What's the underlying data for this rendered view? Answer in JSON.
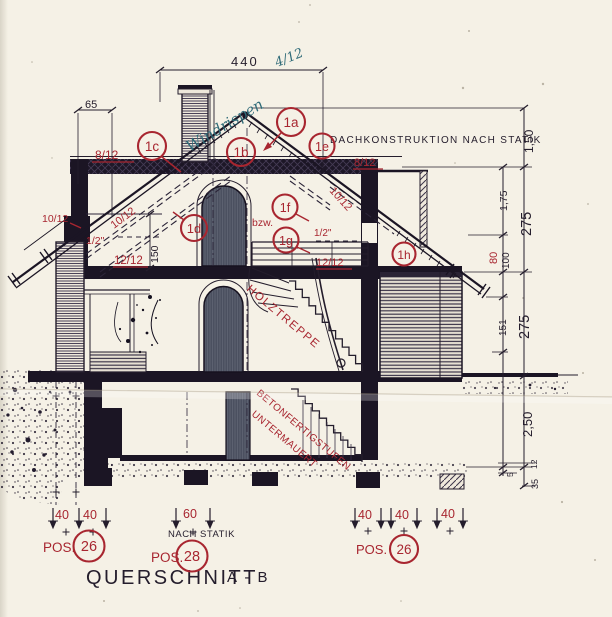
{
  "colors": {
    "red": "#a82630",
    "ink": "#241d2c",
    "blue": "#2f6b78",
    "paper": "#f5f1e6"
  },
  "title": {
    "label": "QUERSCHNITT",
    "section": "A - B"
  },
  "notes": {
    "roof_construction": "DACHKONSTRUKTION NACH STATIK",
    "per_statics": "NACH STATIK"
  },
  "handwriting": {
    "word": "Windrispen",
    "ratio": "4/12"
  },
  "stair_labels": {
    "wood": "HOLZTREPPE",
    "concrete_line1": "BETONFERTIGSTUFEN",
    "concrete_line2": "UNTERMAUERT"
  },
  "callouts": {
    "c1a": "1a",
    "c1b": "1b",
    "c1c": "1c",
    "c1d": "1d",
    "c1e": "1e",
    "c1f": "1f",
    "c1g": "1g",
    "c1h": "1h"
  },
  "slope_labels": {
    "left_8": "8/12",
    "right_8": "8/12",
    "left_10_out": "10/12",
    "left_10": "10/12",
    "right_10": "10/12",
    "half_left": "1/2\"",
    "half_right": "1/2\"",
    "left_12": "12/12",
    "right_12": "12/12",
    "bzw": "bzw."
  },
  "dims": {
    "top_width": "440",
    "eave_offset": "65",
    "collar_height": "150",
    "right_outer": [
      "1,50",
      "275",
      "275",
      "2,50"
    ],
    "right_inner": [
      "1,75",
      "100",
      "151"
    ],
    "right_inner_red": "80",
    "right_small": [
      "12",
      "5",
      "35"
    ],
    "bottom_left": [
      "40",
      "40"
    ],
    "bottom_mid": "60",
    "bottom_right": [
      "40",
      "40",
      "40"
    ]
  },
  "positions": {
    "left": {
      "pos": "POS.",
      "num": "26"
    },
    "mid": {
      "pos": "POS.",
      "num": "28"
    },
    "right": {
      "pos": "POS.",
      "num": "26"
    }
  }
}
